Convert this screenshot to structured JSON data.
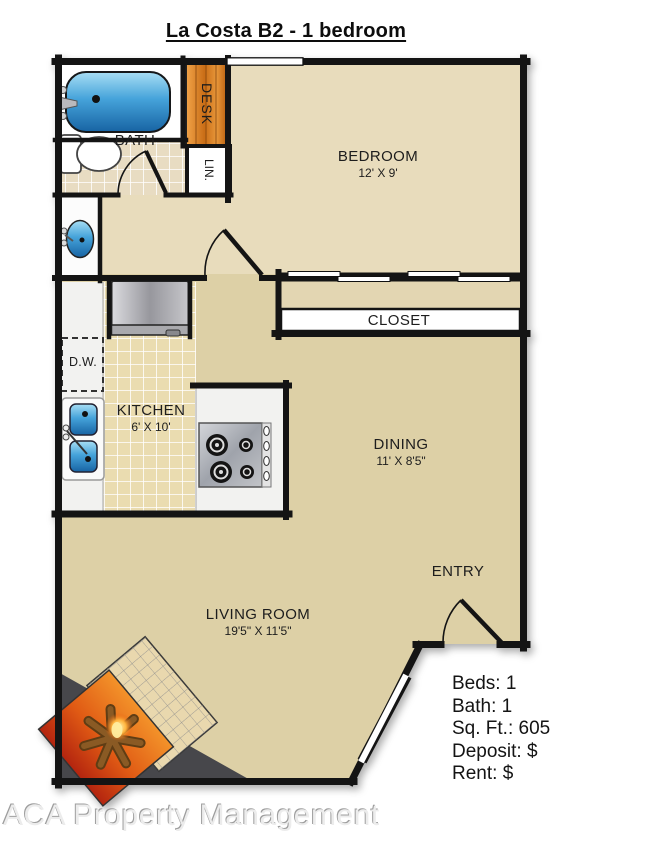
{
  "title": "La Costa B2 - 1 bedroom",
  "rooms": {
    "bath": {
      "label": "BATH"
    },
    "desk": {
      "label": "DESK"
    },
    "linen": {
      "label": "LIN."
    },
    "bedroom": {
      "label": "BEDROOM",
      "dimensions": "12' X 9'"
    },
    "closet": {
      "label": "CLOSET"
    },
    "kitchen": {
      "label": "KITCHEN",
      "dimensions": "6' X 10'"
    },
    "dishwasher": {
      "label": "D.W."
    },
    "dining": {
      "label": "DINING",
      "dimensions": "11' X 8'5\""
    },
    "entry": {
      "label": "ENTRY"
    },
    "living_room": {
      "label": "LIVING ROOM",
      "dimensions": "19'5\" X 11'5\""
    }
  },
  "details": {
    "lines": [
      "Beds: 1",
      "Bath: 1",
      "Sq. Ft.: 605",
      "Deposit: $",
      "Rent: $"
    ]
  },
  "footer": {
    "company": "ACA Property Management"
  },
  "fixtures": [
    "bathtub-icon",
    "toilet-icon",
    "vanity-sink-icon",
    "refrigerator-icon",
    "dishwasher-icon",
    "kitchen-sink-icon",
    "stove-cooktop-icon",
    "fireplace-icon"
  ],
  "colors": {
    "wall": "#141414",
    "floor_tan": "#ddd0a6",
    "floor_tan_light": "#e8dcbc",
    "tile_kitchen": "#eadcb0",
    "tub_blue": "#2e8fd0",
    "desk_wood": "#d97e28",
    "fireplace_orange": "#e06a18",
    "counter_white": "#f2f2f0"
  }
}
